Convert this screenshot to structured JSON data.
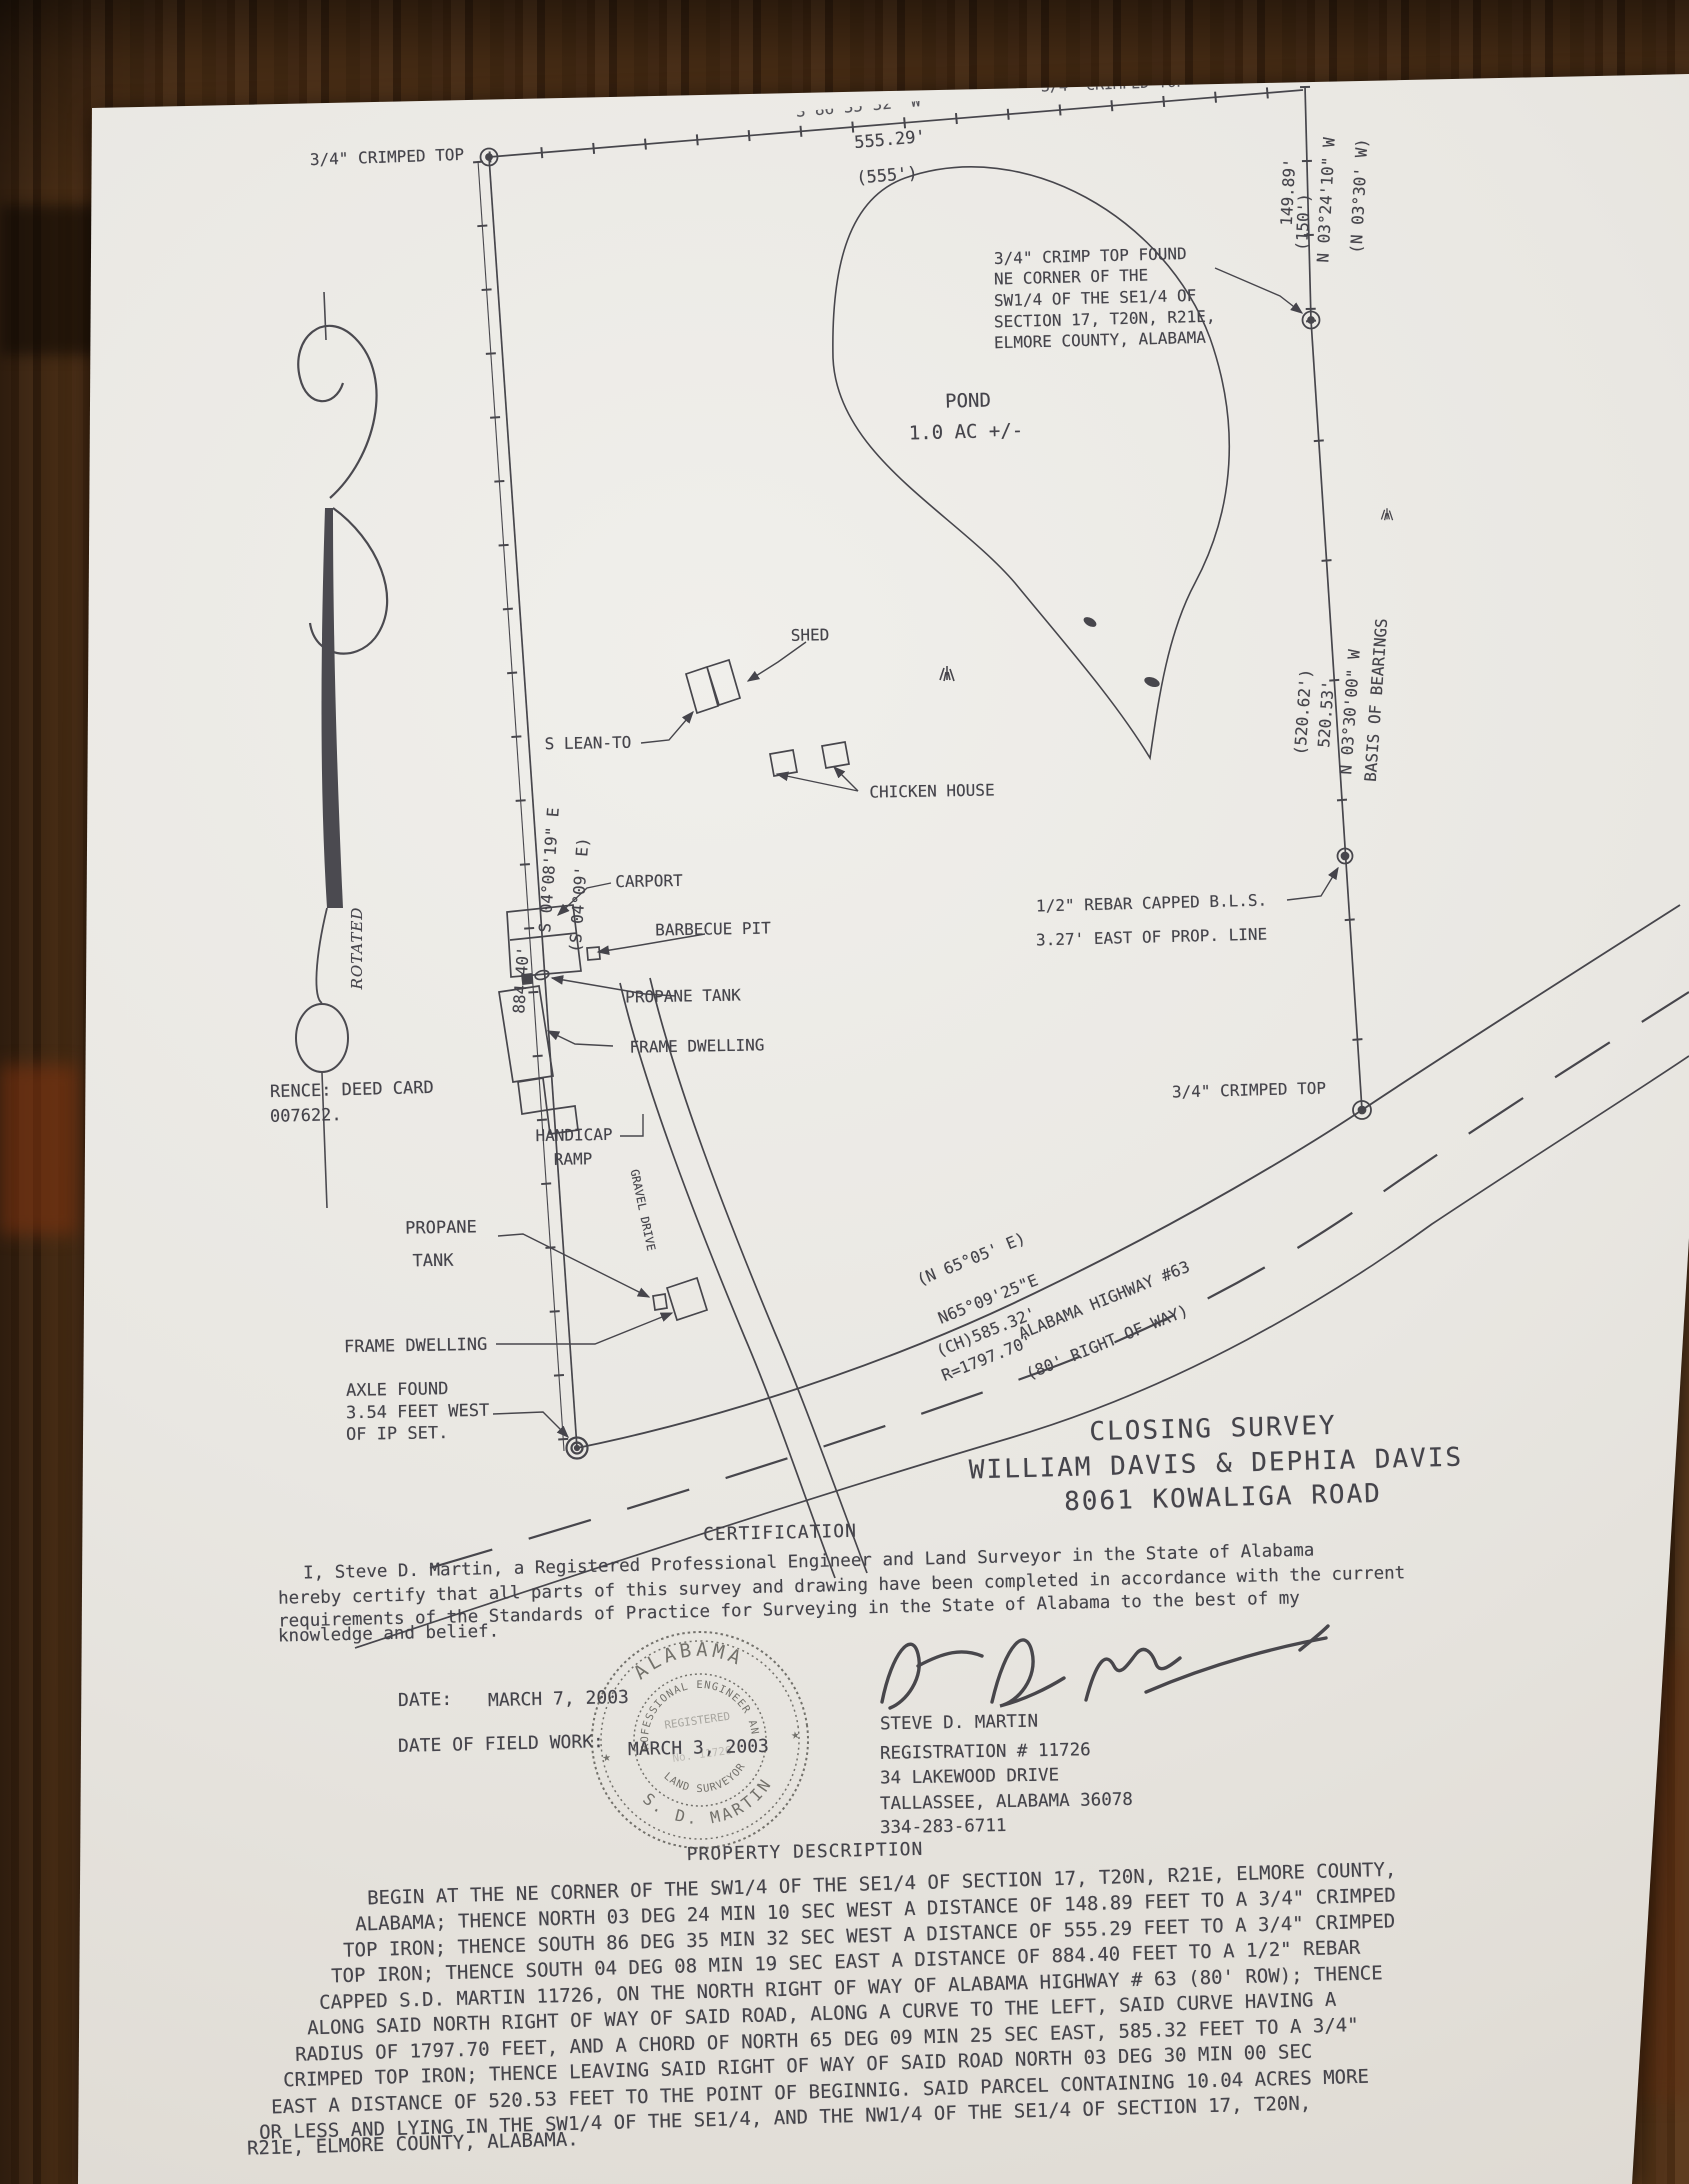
{
  "colors": {
    "ink": "#45444b",
    "paper": "#e9e7e2",
    "wood": "#4a2c13",
    "wood_red": "#84340f"
  },
  "plat": {
    "labels": [
      {
        "name": "nw-monument-label",
        "t": "3/4\" CRIMPED TOP",
        "x": 387,
        "y": 157,
        "r": -2,
        "s": 16
      },
      {
        "name": "north-line-bearing",
        "t": "S 86°35'32\" W",
        "x": 858,
        "y": 106,
        "r": -5,
        "s": 16,
        "cls": "cut"
      },
      {
        "name": "north-line-distance",
        "t": "555.29'",
        "x": 890,
        "y": 140,
        "r": -5,
        "s": 17
      },
      {
        "name": "north-line-distance-deed",
        "t": "(555')",
        "x": 887,
        "y": 176,
        "r": -5,
        "s": 17
      },
      {
        "name": "northeast-cut-label",
        "t": "3/4\" CRIMPED TOP",
        "x": 1113,
        "y": 84,
        "r": -2,
        "s": 15,
        "cls": "cut"
      },
      {
        "name": "east-line1-bearing",
        "t": "N 03°24'10\" W",
        "x": 1326,
        "y": 200,
        "r": -87,
        "s": 16
      },
      {
        "name": "east-line1-bearing-deed",
        "t": "(N 03°30' W)",
        "x": 1359,
        "y": 196,
        "r": -87,
        "s": 16
      },
      {
        "name": "east-line1-distance",
        "t": "149.89'",
        "x": 1288,
        "y": 192,
        "r": -87,
        "s": 16
      },
      {
        "name": "east-line1-distance-deed",
        "t": "(150')",
        "x": 1303,
        "y": 222,
        "r": -87,
        "s": 16
      },
      {
        "name": "m1-note-1",
        "t": "3/4\" CRIMP TOP FOUND",
        "x": 994,
        "y": 256,
        "r": -1.5,
        "s": 16,
        "a": "l"
      },
      {
        "name": "m1-note-2",
        "t": "NE CORNER OF THE",
        "x": 994,
        "y": 277,
        "r": -1.5,
        "s": 16,
        "a": "l"
      },
      {
        "name": "m1-note-3",
        "t": "SW1/4 OF THE SE1/4 OF",
        "x": 994,
        "y": 298,
        "r": -1.5,
        "s": 16,
        "a": "l"
      },
      {
        "name": "m1-note-4",
        "t": "SECTION 17, T20N, R21E,",
        "x": 994,
        "y": 319,
        "r": -1.5,
        "s": 16,
        "a": "l"
      },
      {
        "name": "m1-note-5",
        "t": "ELMORE COUNTY, ALABAMA",
        "x": 994,
        "y": 340,
        "r": -1.5,
        "s": 16,
        "a": "l"
      },
      {
        "name": "pond-label",
        "t": "POND",
        "x": 968,
        "y": 401,
        "r": -1.5,
        "s": 19
      },
      {
        "name": "pond-area",
        "t": "1.0 AC +/-",
        "x": 966,
        "y": 432,
        "r": -1.5,
        "s": 19
      },
      {
        "name": "basis-of-bearings",
        "t": "BASIS OF BEARINGS",
        "x": 1376,
        "y": 700,
        "r": -86,
        "s": 16
      },
      {
        "name": "east-line2-bearing",
        "t": "N 03°30'00\" W",
        "x": 1350,
        "y": 712,
        "r": -86,
        "s": 16
      },
      {
        "name": "east-line2-distance",
        "t": "520.53'",
        "x": 1326,
        "y": 714,
        "r": -86,
        "s": 16
      },
      {
        "name": "east-line2-distance-deed",
        "t": "(520.62')",
        "x": 1303,
        "y": 712,
        "r": -86,
        "s": 16
      },
      {
        "name": "rebar-note-1",
        "t": "1/2\" REBAR CAPPED B.L.S.",
        "x": 1036,
        "y": 903,
        "r": -1.5,
        "s": 16,
        "a": "l"
      },
      {
        "name": "rebar-note-2",
        "t": "3.27' EAST OF PROP. LINE",
        "x": 1036,
        "y": 937,
        "r": -1.5,
        "s": 16,
        "a": "l"
      },
      {
        "name": "m2-label",
        "t": "3/4\" CRIMPED TOP",
        "x": 1249,
        "y": 1090,
        "r": -1.5,
        "s": 16
      },
      {
        "name": "shed-upper-label",
        "t": "SHED",
        "x": 810,
        "y": 635,
        "r": -1,
        "s": 16
      },
      {
        "name": "lean-to-label",
        "t": "S LEAN-TO",
        "x": 588,
        "y": 743,
        "r": -1,
        "s": 16
      },
      {
        "name": "chicken-house-label",
        "t": "CHICKEN HOUSE",
        "x": 932,
        "y": 791,
        "r": -1,
        "s": 16
      },
      {
        "name": "carport-label",
        "t": "CARPORT",
        "x": 649,
        "y": 881,
        "r": -1,
        "s": 16
      },
      {
        "name": "barbecue-pit-label",
        "t": "BARBECUE PIT",
        "x": 713,
        "y": 929,
        "r": -1,
        "s": 16
      },
      {
        "name": "propane-tank-upper-label",
        "t": "PROPANE TANK",
        "x": 683,
        "y": 996,
        "r": -1,
        "s": 16
      },
      {
        "name": "frame-dwelling-upper-label",
        "t": "FRAME DWELLING",
        "x": 697,
        "y": 1046,
        "r": -1,
        "s": 16
      },
      {
        "name": "handicap-label-1",
        "t": "HANDICAP",
        "x": 574,
        "y": 1135,
        "r": -1,
        "s": 16
      },
      {
        "name": "handicap-label-2",
        "t": "RAMP",
        "x": 573,
        "y": 1159,
        "r": -1,
        "s": 16
      },
      {
        "name": "west-line-bearing",
        "t": "S 04°08'19\" E",
        "x": 549,
        "y": 870,
        "r": -86,
        "s": 16
      },
      {
        "name": "west-line-bearing-deed",
        "t": "(S 04°09' E)",
        "x": 579,
        "y": 895,
        "r": -86,
        "s": 16
      },
      {
        "name": "west-line-distance",
        "t": "884.40'",
        "x": 521,
        "y": 980,
        "r": -86,
        "s": 16
      },
      {
        "name": "deed-reference-1",
        "t": "RENCE: DEED CARD",
        "x": 270,
        "y": 1090,
        "r": -1.5,
        "s": 17,
        "a": "l"
      },
      {
        "name": "deed-reference-2",
        "t": "007622.",
        "x": 270,
        "y": 1116,
        "r": -1.5,
        "s": 17,
        "a": "l"
      },
      {
        "name": "gravel-drive-label",
        "t": "GRAVEL DRIVE",
        "x": 643,
        "y": 1210,
        "r": 78,
        "s": 11.5
      },
      {
        "name": "propane-lower-label-1",
        "t": "PROPANE",
        "x": 441,
        "y": 1228,
        "r": -1,
        "s": 17
      },
      {
        "name": "propane-lower-label-2",
        "t": "TANK",
        "x": 433,
        "y": 1261,
        "r": -1,
        "s": 17
      },
      {
        "name": "frame-dwelling-lower-label",
        "t": "FRAME DWELLING",
        "x": 344,
        "y": 1346,
        "r": -1,
        "s": 17,
        "a": "l"
      },
      {
        "name": "axle-note-1",
        "t": "AXLE FOUND",
        "x": 346,
        "y": 1390,
        "r": -1,
        "s": 17,
        "a": "l"
      },
      {
        "name": "axle-note-2",
        "t": "3.54 FEET WEST",
        "x": 346,
        "y": 1412,
        "r": -1,
        "s": 17,
        "a": "l"
      },
      {
        "name": "axle-note-3",
        "t": "OF IP SET.",
        "x": 346,
        "y": 1434,
        "r": -1,
        "s": 17,
        "a": "l"
      },
      {
        "name": "curve-bearing-deed",
        "t": "(N 65°05' E)",
        "x": 971,
        "y": 1259,
        "r": -22,
        "s": 16
      },
      {
        "name": "curve-bearing",
        "t": "N65°09'25\"E",
        "x": 988,
        "y": 1299,
        "r": -22,
        "s": 16
      },
      {
        "name": "curve-chord",
        "t": "(CH)585.32'",
        "x": 986,
        "y": 1332,
        "r": -22,
        "s": 16
      },
      {
        "name": "curve-radius",
        "t": "R=1797.70'",
        "x": 987,
        "y": 1358,
        "r": -22,
        "s": 16
      },
      {
        "name": "highway-name",
        "t": "ALABAMA HIGHWAY #63",
        "x": 1104,
        "y": 1300,
        "r": -22,
        "s": 16
      },
      {
        "name": "highway-row",
        "t": "(80' RIGHT OF WAY)",
        "x": 1107,
        "y": 1342,
        "r": -22,
        "s": 16
      },
      {
        "name": "rotated-note",
        "t": "ROTATED",
        "x": 357,
        "y": 948,
        "r": -90,
        "s": 15,
        "cls": "serif-it"
      }
    ]
  },
  "title_block": {
    "lines": [
      {
        "name": "survey-title",
        "t": "CLOSING SURVEY",
        "x": 1213,
        "y": 1429,
        "r": -1.5,
        "s": 26,
        "ls": 2,
        "cls": "title"
      },
      {
        "name": "survey-owners",
        "t": "WILLIAM DAVIS & DEPHIA DAVIS",
        "x": 1216,
        "y": 1464,
        "r": -1.5,
        "s": 26,
        "cls": "title"
      },
      {
        "name": "survey-address",
        "t": "8061 KOWALIGA ROAD",
        "x": 1223,
        "y": 1498,
        "r": -1.5,
        "s": 26,
        "cls": "title"
      }
    ]
  },
  "certification": {
    "items": [
      {
        "name": "certification-heading",
        "t": "CERTIFICATION",
        "x": 780,
        "y": 1533,
        "r": -1.3,
        "s": 18,
        "ls": 1
      },
      {
        "name": "certification-line-1",
        "t": "I, Steve D. Martin, a Registered Professional Engineer and Land Surveyor in the State of Alabama",
        "x": 303,
        "y": 1562,
        "r": -1.3,
        "s": 17.5,
        "a": "l"
      },
      {
        "name": "certification-line-2",
        "t": "hereby certify that all parts of this survey and drawing have been completed in accordance with the current",
        "x": 278,
        "y": 1586,
        "r": -1.3,
        "s": 17.5,
        "a": "l"
      },
      {
        "name": "certification-line-3",
        "t": "requirements of the Standards of Practice for Surveying in the State of Alabama to the best of my",
        "x": 278,
        "y": 1610,
        "r": -1.3,
        "s": 17.5,
        "a": "l"
      },
      {
        "name": "certification-line-4",
        "t": "knowledge and belief.",
        "x": 278,
        "y": 1634,
        "r": -1.3,
        "s": 17.5,
        "a": "l"
      }
    ]
  },
  "dates": {
    "items": [
      {
        "name": "date-label",
        "t": "DATE:",
        "x": 398,
        "y": 1700,
        "r": -1.3,
        "s": 18,
        "a": "l"
      },
      {
        "name": "date-value",
        "t": "MARCH 7, 2003",
        "x": 488,
        "y": 1699,
        "r": -1.3,
        "s": 18,
        "a": "l"
      },
      {
        "name": "fieldwork-label",
        "t": "DATE OF FIELD WORK:",
        "x": 398,
        "y": 1744,
        "r": -1.3,
        "s": 18,
        "a": "l"
      },
      {
        "name": "fieldwork-value",
        "t": "MARCH 3, 2003",
        "x": 628,
        "y": 1748,
        "r": -1.3,
        "s": 18,
        "a": "l"
      }
    ]
  },
  "surveyor": {
    "items": [
      {
        "name": "surveyor-name",
        "t": "STEVE D. MARTIN",
        "x": 880,
        "y": 1723,
        "r": -1,
        "s": 17.5,
        "a": "l"
      },
      {
        "name": "surveyor-registration",
        "t": "REGISTRATION # 11726",
        "x": 880,
        "y": 1752,
        "r": -1,
        "s": 17.5,
        "a": "l"
      },
      {
        "name": "surveyor-street",
        "t": "34 LAKEWOOD DRIVE",
        "x": 880,
        "y": 1777,
        "r": -1,
        "s": 17.5,
        "a": "l"
      },
      {
        "name": "surveyor-city",
        "t": "TALLASSEE, ALABAMA 36078",
        "x": 880,
        "y": 1802,
        "r": -1,
        "s": 17.5,
        "a": "l"
      },
      {
        "name": "surveyor-phone",
        "t": "334-283-6711",
        "x": 880,
        "y": 1827,
        "r": -1,
        "s": 17.5,
        "a": "l"
      }
    ]
  },
  "seal": {
    "state": "ALABAMA",
    "ring_top": "PROFESSIONAL ENGINEER AND",
    "ring_bottom": "LAND SURVEYOR",
    "registered": "REGISTERED",
    "number": "No. 11726",
    "name": "S. D. MARTIN"
  },
  "description": {
    "items": [
      {
        "name": "property-description-heading",
        "t": "PROPERTY DESCRIPTION",
        "x": 805,
        "y": 1852,
        "r": -1.3,
        "s": 18,
        "ls": 1
      },
      {
        "name": "description-line-1",
        "t": "BEGIN AT THE NE CORNER OF THE SW1/4 OF THE SE1/4 OF SECTION 17, T20N, R21E, ELMORE COUNTY,",
        "x": 367,
        "y": 1884,
        "r": -1.6,
        "s": 19,
        "a": "l"
      },
      {
        "name": "description-line-2",
        "t": "ALABAMA;  THENCE NORTH 03 DEG 24 MIN 10 SEC WEST A DISTANCE OF 148.89 FEET TO A 3/4\" CRIMPED",
        "x": 355,
        "y": 1910,
        "r": -1.6,
        "s": 19,
        "a": "l"
      },
      {
        "name": "description-line-3",
        "t": "TOP IRON;  THENCE SOUTH 86 DEG 35 MIN 32 SEC WEST A DISTANCE OF 555.29 FEET TO A 3/4\" CRIMPED",
        "x": 343,
        "y": 1936,
        "r": -1.6,
        "s": 19,
        "a": "l"
      },
      {
        "name": "description-line-4",
        "t": "TOP IRON;  THENCE SOUTH 04 DEG 08 MIN 19 SEC EAST A DISTANCE OF 884.40 FEET TO A 1/2\" REBAR",
        "x": 331,
        "y": 1962,
        "r": -1.6,
        "s": 19,
        "a": "l"
      },
      {
        "name": "description-line-5",
        "t": "CAPPED S.D. MARTIN 11726, ON THE NORTH RIGHT OF WAY OF ALABAMA HIGHWAY # 63 (80' ROW);  THENCE",
        "x": 319,
        "y": 1988,
        "r": -1.6,
        "s": 19,
        "a": "l"
      },
      {
        "name": "description-line-6",
        "t": "ALONG SAID NORTH RIGHT OF WAY OF SAID ROAD, ALONG A CURVE TO THE LEFT, SAID CURVE HAVING A",
        "x": 307,
        "y": 2014,
        "r": -1.6,
        "s": 19,
        "a": "l"
      },
      {
        "name": "description-line-7",
        "t": "RADIUS OF 1797.70 FEET, AND A CHORD OF NORTH 65 DEG 09 MIN 25 SEC EAST, 585.32 FEET TO A 3/4\"",
        "x": 295,
        "y": 2040,
        "r": -1.6,
        "s": 19,
        "a": "l"
      },
      {
        "name": "description-line-8",
        "t": "CRIMPED TOP IRON;  THENCE LEAVING SAID RIGHT OF WAY OF SAID ROAD NORTH 03 DEG 30 MIN 00 SEC",
        "x": 283,
        "y": 2066,
        "r": -1.6,
        "s": 19,
        "a": "l"
      },
      {
        "name": "description-line-9",
        "t": "EAST A DISTANCE OF 520.53 FEET TO THE POINT OF BEGINNIG.  SAID PARCEL CONTAINING 10.04 ACRES MORE",
        "x": 271,
        "y": 2092,
        "r": -1.6,
        "s": 19,
        "a": "l"
      },
      {
        "name": "description-line-10",
        "t": "OR LESS AND LYING IN THE SW1/4 OF THE SE1/4, AND THE NW1/4 OF THE SE1/4 OF SECTION 17, T20N,",
        "x": 259,
        "y": 2118,
        "r": -1.6,
        "s": 19,
        "a": "l"
      },
      {
        "name": "description-line-11",
        "t": "R21E, ELMORE COUNTY, ALABAMA.",
        "x": 247,
        "y": 2144,
        "r": -1.6,
        "s": 19,
        "a": "l"
      }
    ]
  }
}
